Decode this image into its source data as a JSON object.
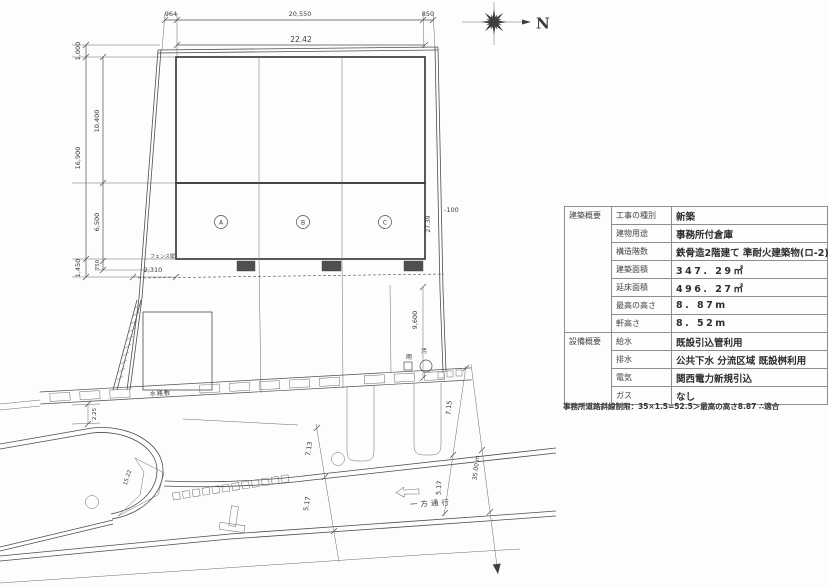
{
  "drawing": {
    "dims": {
      "top_left": "964",
      "top_mid": "20,550",
      "top_right": "850",
      "building_width": "22.42",
      "left_outer_top": "1,000",
      "left_outer_mid": "16,900",
      "left_outer_bot": "1,450",
      "left_inner_top": "10,400",
      "left_inner_mid": "6,500",
      "left_inner_bot": "750",
      "right_height": "27.39",
      "level": "-100",
      "east_gap": "9,600",
      "fence_offset": "2,310",
      "west_gap": "2.25",
      "corner_len": "15.22",
      "road_width_a": "7.13",
      "road_width_b": "5.17",
      "road_width_c": "7.15",
      "road_width_d": "5.17",
      "road_length": "35.00 m"
    },
    "labels": {
      "north": "N",
      "fence": "フェンス塀",
      "waterway": "水路敷",
      "one_way": "一方通行",
      "rain_drain": "雨",
      "sewer_drain": "汚",
      "unit_a": "A",
      "unit_b": "B",
      "unit_c": "C"
    }
  },
  "table": {
    "groups": [
      {
        "name": "建築概要",
        "rows": [
          [
            "工事の種別",
            "新築"
          ],
          [
            "建物用途",
            "事務所付倉庫"
          ],
          [
            "構造階数",
            "鉄骨造2階建て 準耐火建築物(ロ-2)"
          ],
          [
            "建築面積",
            "347. 29㎡"
          ],
          [
            "延床面積",
            "496. 27㎡"
          ],
          [
            "最高の高さ",
            "8. 87m"
          ],
          [
            "軒高さ",
            "8. 52m"
          ]
        ]
      },
      {
        "name": "設備概要",
        "rows": [
          [
            "給水",
            "既設引込管利用"
          ],
          [
            "排水",
            "公共下水 分流区域  既設桝利用"
          ],
          [
            "電気",
            "関西電力新規引込"
          ],
          [
            "ガス",
            "なし"
          ]
        ]
      }
    ],
    "note": "事務所道路斜線制限：35×1.5=52.5＞最高の高さ8.87 ∴適合"
  }
}
